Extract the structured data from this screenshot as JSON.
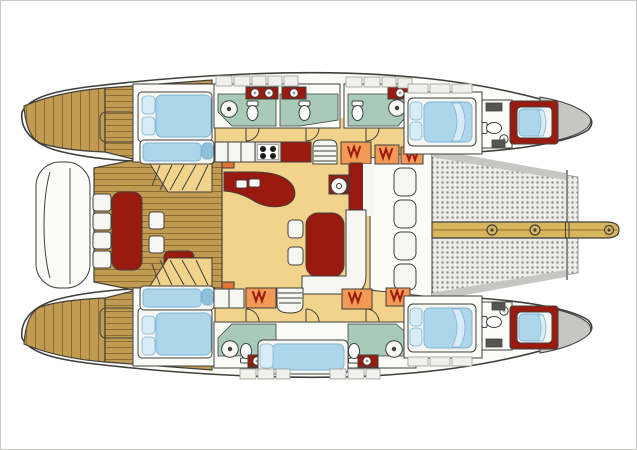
{
  "figure": {
    "type": "diagram",
    "subject": "Sailing catamaran accommodation deck plan, top view, bow to the right"
  },
  "palette": {
    "paper": "#ffffff",
    "frame": "#c9c9c5",
    "line": "#3f3f3c",
    "hull-white": "#fbfbf8",
    "deck-gray": "#c6c6c2",
    "cab-bg": "#f0f0ec",
    "cab-line": "#9a9a96",
    "teak": "#c29b52",
    "teak-line": "#8e6c2f",
    "sand": "#f2d38c",
    "orange": "#f29a55",
    "orange-deep": "#e2762f",
    "maroon": "#9b1a10",
    "bed-blue": "#aed6eb",
    "bed-blue-deep": "#7fb4d4",
    "pillow": "#d8ecf7",
    "teal": "#a9cab8",
    "white-furn": "#f6f6f2",
    "beam-wood": "#d9b55e",
    "tramp-bg": "#ecece8",
    "tramp-dot": "#8f8f8b"
  },
  "areas": [
    "aft-cockpit",
    "dinghy-platform",
    "saloon",
    "galley",
    "nav-helm",
    "port-aft-cabin",
    "starboard-aft-cabin",
    "center-berth-cabin",
    "port-forward-guest-cabin",
    "starboard-forward-guest-cabin",
    "forward-crew-cabins",
    "bathrooms",
    "forward-cockpit",
    "trampoline",
    "bowsprit-beam"
  ]
}
